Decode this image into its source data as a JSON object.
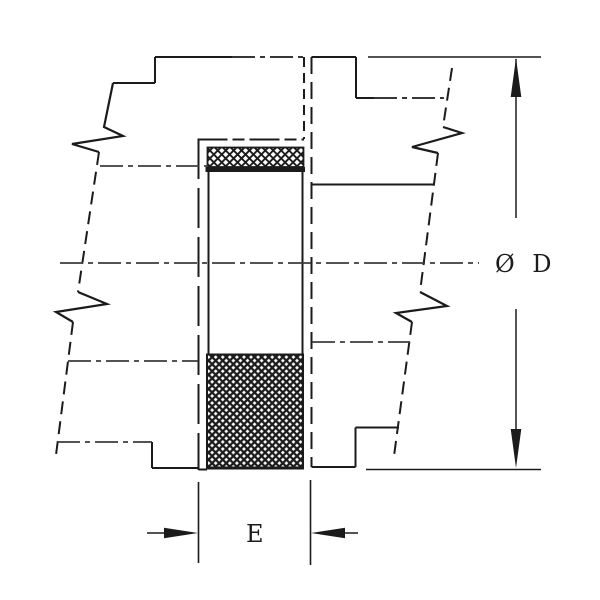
{
  "drawing": {
    "labels": {
      "diameter": "Ø D",
      "width": "E"
    },
    "colors": {
      "ink": "#1b1b1b",
      "centerline": "#3c3c3c",
      "background": "#ffffff"
    }
  }
}
